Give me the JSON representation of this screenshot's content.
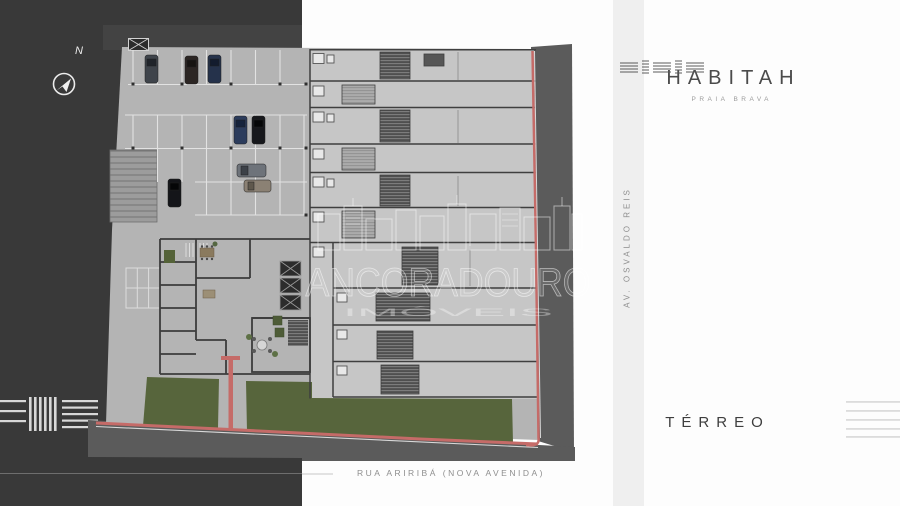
{
  "branding": {
    "logo_text": "HABITAH",
    "logo_subtext": "PRAIA BRAVA"
  },
  "floor": {
    "label": "TÉRREO"
  },
  "streets": {
    "right_vertical_label": "AV. OSVALDO REIS",
    "bottom_label": "RUA ARIRIBÁ (NOVA AVENIDA)"
  },
  "compass": {
    "north_label": "N"
  },
  "watermark": {
    "title": "ANCORADOURO",
    "subtitle": "IMÓVEIS"
  },
  "icons": {
    "compass": "compass-icon",
    "logo_mark": "habitah-logo-mark-icon",
    "skyline": "watermark-skyline-icon"
  },
  "colors": {
    "panel_charcoal": "#393939",
    "plan_slab": "#b4b4b4",
    "unit_slab": "#c6c6c6",
    "street_asphalt": "#5b5b5b",
    "curb_red": "#c56b68",
    "lawn_green": "#57653c",
    "side_band": "#efefef",
    "logo_text": "#4b4b4b"
  }
}
